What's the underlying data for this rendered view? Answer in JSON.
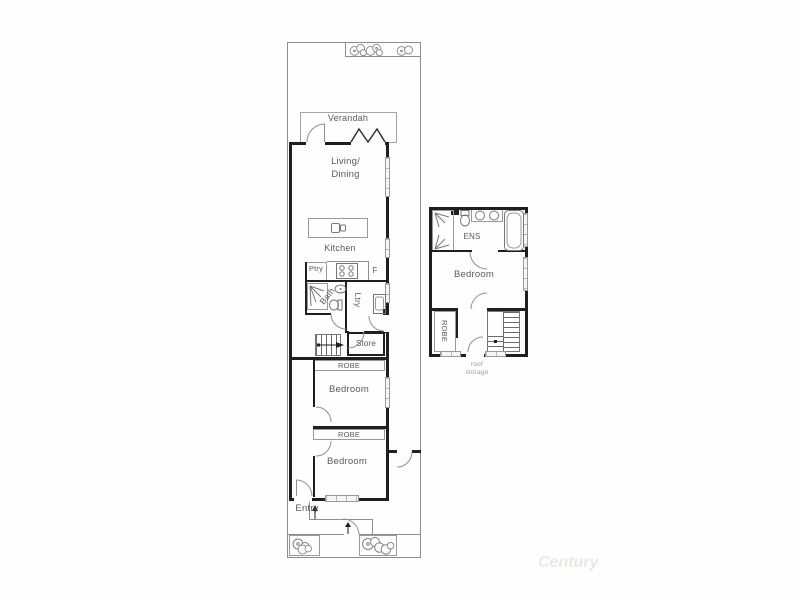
{
  "colors": {
    "wall": "#1f1f1f",
    "thin_line": "#8f8f8f",
    "label_text": "#5a5a5a",
    "window_fill": "#f6f6f6",
    "watermark": "#ebe9df"
  },
  "ground_floor": {
    "verandah": {
      "label": "Verandah"
    },
    "living_dining": {
      "line1": "Living/",
      "line2": "Dining"
    },
    "kitchen": {
      "label": "Kitchen",
      "pantry": "Ptry",
      "fridge": "F"
    },
    "bath": {
      "label": "Bath"
    },
    "laundry": {
      "label": "Ltry"
    },
    "store": {
      "label": "Store"
    },
    "robe1": {
      "label": "ROBE"
    },
    "bedroom2": {
      "label": "Bedroom"
    },
    "robe2": {
      "label": "ROBE"
    },
    "bedroom3": {
      "label": "Bedroom"
    },
    "entry": {
      "label": "Entry"
    }
  },
  "upper_floor": {
    "ensuite": {
      "label": "ENS"
    },
    "bedroom": {
      "label": "Bedroom"
    },
    "robe": {
      "label": "ROBE"
    },
    "roof_storage": {
      "line1": "roof",
      "line2": "storage"
    }
  },
  "watermark": {
    "text": "Century"
  }
}
